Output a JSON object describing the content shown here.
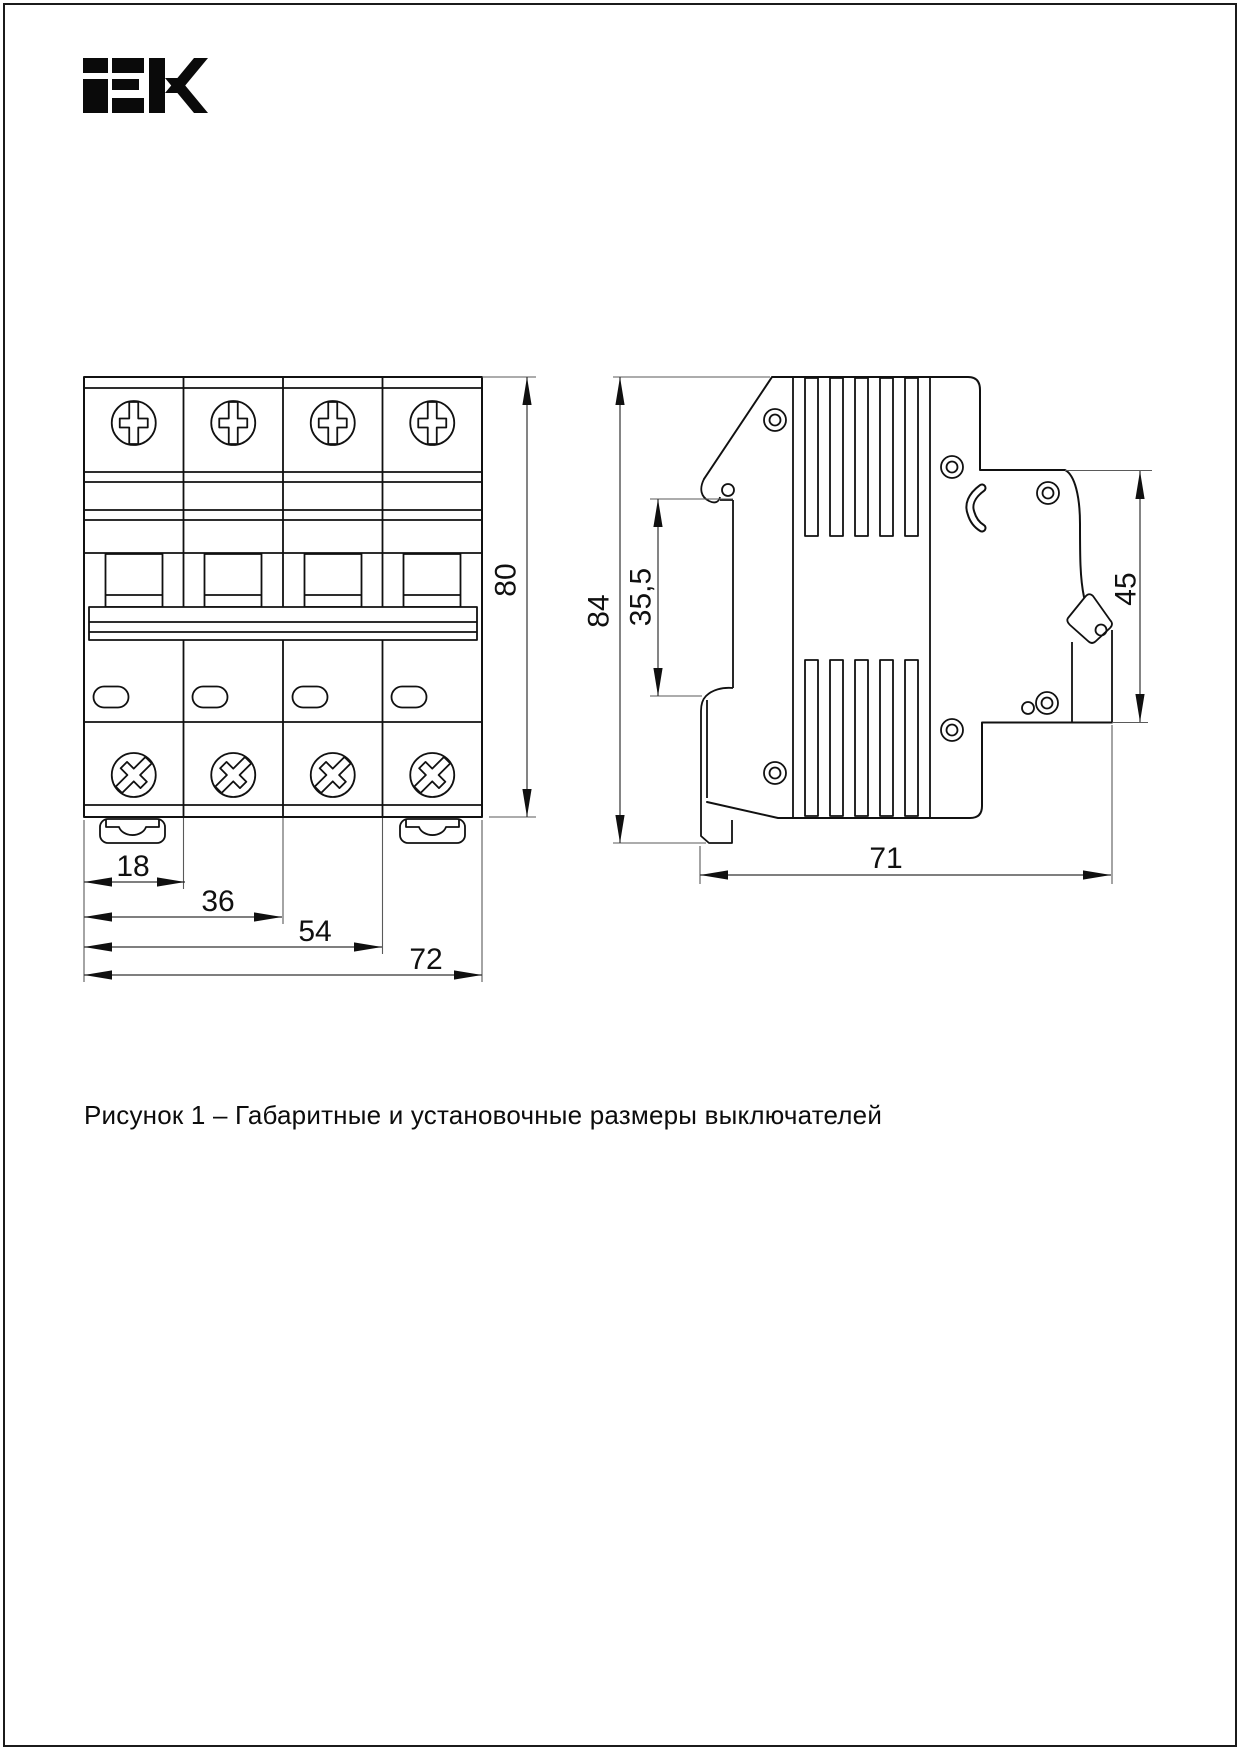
{
  "brand": {
    "logo_text": "IEK"
  },
  "caption": "Рисунок 1 – Габаритные и установочные размеры выключателей",
  "front_view": {
    "dims": {
      "height": "80",
      "module_width": "18",
      "width_2": "36",
      "width_3": "54",
      "width_total": "72"
    }
  },
  "side_view": {
    "dims": {
      "height": "84",
      "rail_to_front": "35,5",
      "terminal_side": "45",
      "depth": "71"
    }
  },
  "colors": {
    "ink": "#111111",
    "paper": "#ffffff"
  }
}
